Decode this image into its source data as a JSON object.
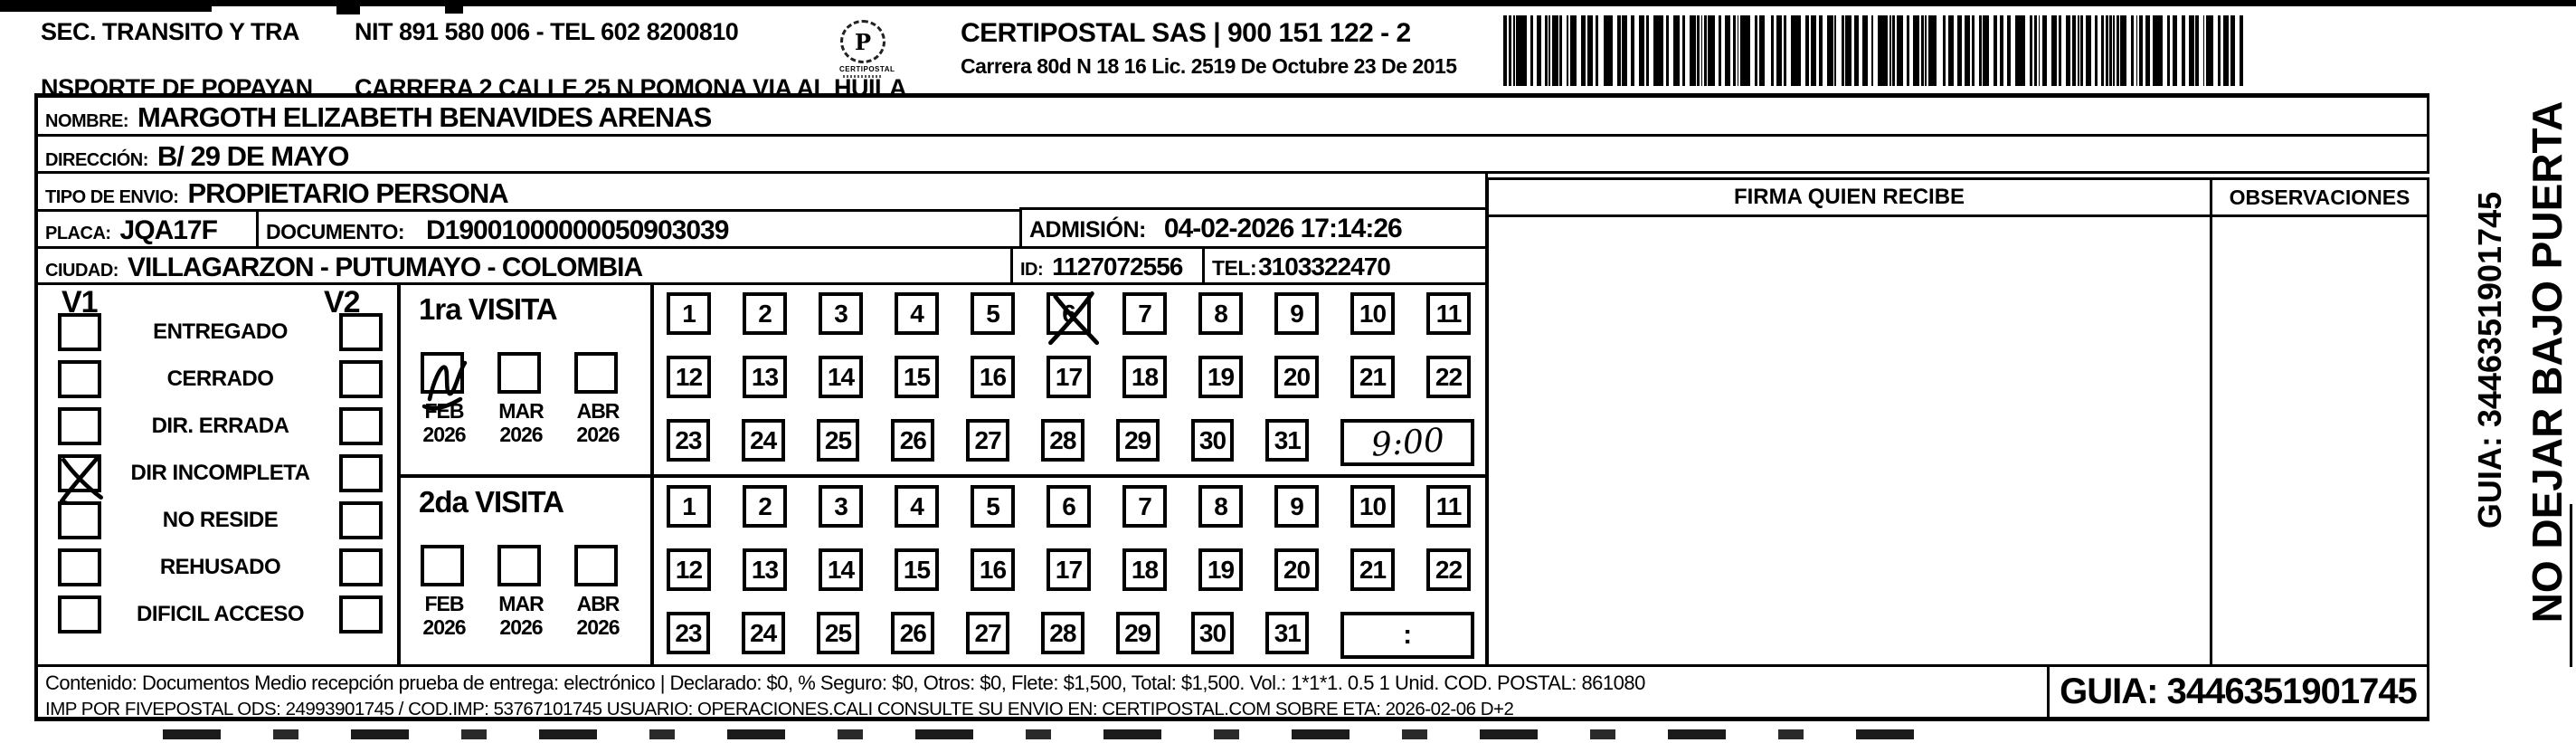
{
  "header": {
    "sender": {
      "line1": "SEC. TRANSITO Y TRA",
      "line2": "NSPORTE DE POPAYAN"
    },
    "sender_contact": {
      "line1": "NIT 891 580 006 - TEL 602 8200810",
      "line2": "CARRERA 2 CALLE 25 N POMONA VIA AL HUILA"
    },
    "logo": {
      "glyph": "P",
      "caption": "CERTIPOSTAL"
    },
    "courier": {
      "line1": "CERTIPOSTAL SAS | 900 151 122 - 2",
      "line2": "Carrera 80d N 18 16  Lic. 2519 De Octubre 23 De 2015"
    }
  },
  "shipment": {
    "nombre": {
      "label": "NOMBRE:",
      "value": "MARGOTH ELIZABETH BENAVIDES ARENAS"
    },
    "direccion": {
      "label": "DIRECCIÓN:",
      "value": "B/ 29 DE MAYO"
    },
    "tipo_envio": {
      "label": "TIPO DE ENVIO:",
      "value": "PROPIETARIO PERSONA"
    },
    "placa": {
      "label": "PLACA:",
      "value": "JQA17F"
    },
    "documento": {
      "label": "DOCUMENTO:",
      "value": "D19001000000050903039"
    },
    "admision": {
      "label": "ADMISIÓN:",
      "value": "04-02-2026 17:14:26"
    },
    "ciudad": {
      "label": "CIUDAD:",
      "value": "VILLAGARZON - PUTUMAYO - COLOMBIA"
    },
    "id": {
      "label": "ID:",
      "value": "1127072556"
    },
    "tel": {
      "label": "TEL:",
      "value": "3103322470"
    }
  },
  "status_panel": {
    "visit1_header": "V1",
    "visit2_header": "V2",
    "options": [
      {
        "label": "ENTREGADO",
        "v1_checked": false,
        "v2_checked": false
      },
      {
        "label": "CERRADO",
        "v1_checked": false,
        "v2_checked": false
      },
      {
        "label": "DIR. ERRADA",
        "v1_checked": false,
        "v2_checked": false
      },
      {
        "label": "DIR INCOMPLETA",
        "v1_checked": true,
        "v2_checked": false
      },
      {
        "label": "NO RESIDE",
        "v1_checked": false,
        "v2_checked": false
      },
      {
        "label": "REHUSADO",
        "v1_checked": false,
        "v2_checked": false
      },
      {
        "label": "DIFICIL ACCESO",
        "v1_checked": false,
        "v2_checked": false
      }
    ]
  },
  "visits": [
    {
      "title": "1ra VISITA",
      "months": [
        {
          "month": "FEB",
          "year": "2026",
          "checked": true
        },
        {
          "month": "MAR",
          "year": "2026",
          "checked": false
        },
        {
          "month": "ABR",
          "year": "2026",
          "checked": false
        }
      ],
      "days": [
        1,
        2,
        3,
        4,
        5,
        6,
        7,
        8,
        9,
        10,
        11,
        12,
        13,
        14,
        15,
        16,
        17,
        18,
        19,
        20,
        21,
        22,
        23,
        24,
        25,
        26,
        27,
        28,
        29,
        30,
        31
      ],
      "crossed_day": 6,
      "time_written": "9:00"
    },
    {
      "title": "2da VISITA",
      "months": [
        {
          "month": "FEB",
          "year": "2026",
          "checked": false
        },
        {
          "month": "MAR",
          "year": "2026",
          "checked": false
        },
        {
          "month": "ABR",
          "year": "2026",
          "checked": false
        }
      ],
      "days": [
        1,
        2,
        3,
        4,
        5,
        6,
        7,
        8,
        9,
        10,
        11,
        12,
        13,
        14,
        15,
        16,
        17,
        18,
        19,
        20,
        21,
        22,
        23,
        24,
        25,
        26,
        27,
        28,
        29,
        30,
        31
      ],
      "crossed_day": null,
      "time_written": ":"
    }
  ],
  "receipt": {
    "firma_header": "FIRMA QUIEN RECIBE",
    "observaciones_header": "OBSERVACIONES"
  },
  "side_strip": {
    "warning": "NO DEJAR BAJO PUERTA",
    "guia": "GUIA: 3446351901745"
  },
  "footer": {
    "line1": "Contenido: Documentos Medio recepción prueba de entrega: electrónico | Declarado: $0, % Seguro: $0, Otros: $0, Flete: $1,500, Total: $1,500. Vol.: 1*1*1. 0.5  1 Unid. COD. POSTAL: 861080",
    "line2": "IMP POR FIVEPOSTAL ODS: 24993901745 / COD.IMP: 53767101745 USUARIO: OPERACIONES.CALI CONSULTE SU ENVIO EN: CERTIPOSTAL.COM SOBRE ETA: 2026-02-06 D+2",
    "guia_box": "GUIA: 3446351901745"
  }
}
